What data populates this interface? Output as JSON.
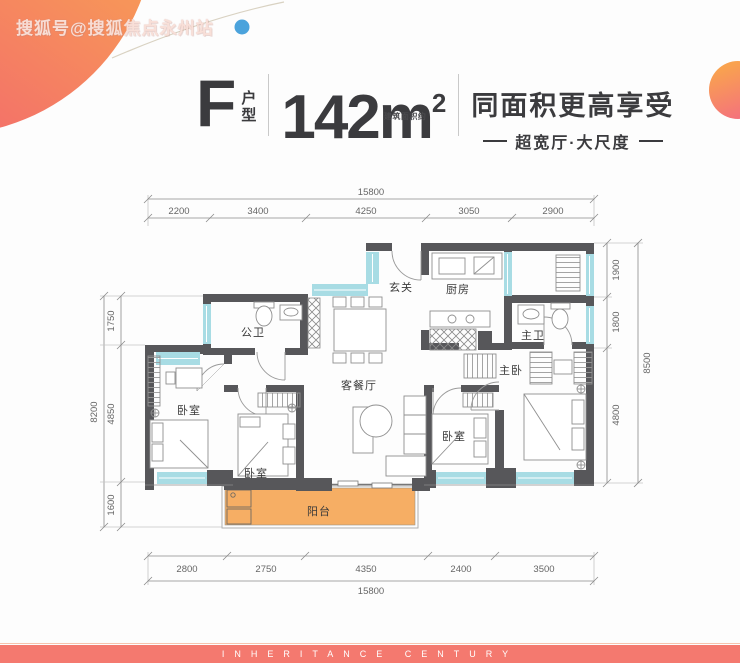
{
  "watermark": "搜狐号@搜狐焦点永州站",
  "title": {
    "type_letter": "F",
    "type_label_top": "户",
    "type_label_bottom": "型",
    "area_number": "142m",
    "area_sup": "2",
    "area_note": "建筑面积约",
    "headline": "同面积更高享受",
    "subline": "超宽厅·大尺度"
  },
  "plan": {
    "rooms": {
      "entry": "玄关",
      "kitchen": "厨房",
      "bath_public": "公卫",
      "bath_master": "主卫",
      "bedroom_master": "主卧",
      "bedroom": "卧室",
      "living": "客餐厅",
      "balcony": "阳台"
    }
  },
  "dims": {
    "top_total": "15800",
    "top_segments": [
      "2200",
      "3400",
      "4250",
      "3050",
      "2900"
    ],
    "bottom_segments": [
      "2800",
      "2750",
      "4350",
      "2400",
      "3500"
    ],
    "bottom_total": "15800",
    "left_total": "8200",
    "left_segments": [
      "1750",
      "4850",
      "1600"
    ],
    "right_segments": [
      "1900",
      "1800",
      "4800"
    ],
    "right_total": "8500"
  },
  "footer": {
    "text": "INHERITANCE CENTURY"
  },
  "colors": {
    "wall": "#57575a",
    "window": "#a8dce4",
    "balcony": "#f6ae64",
    "accent_bar": "#f4796f",
    "circle_orange": "#f9a851",
    "circle_pink": "#f2636f",
    "dot_blue": "#4ba3dc"
  }
}
